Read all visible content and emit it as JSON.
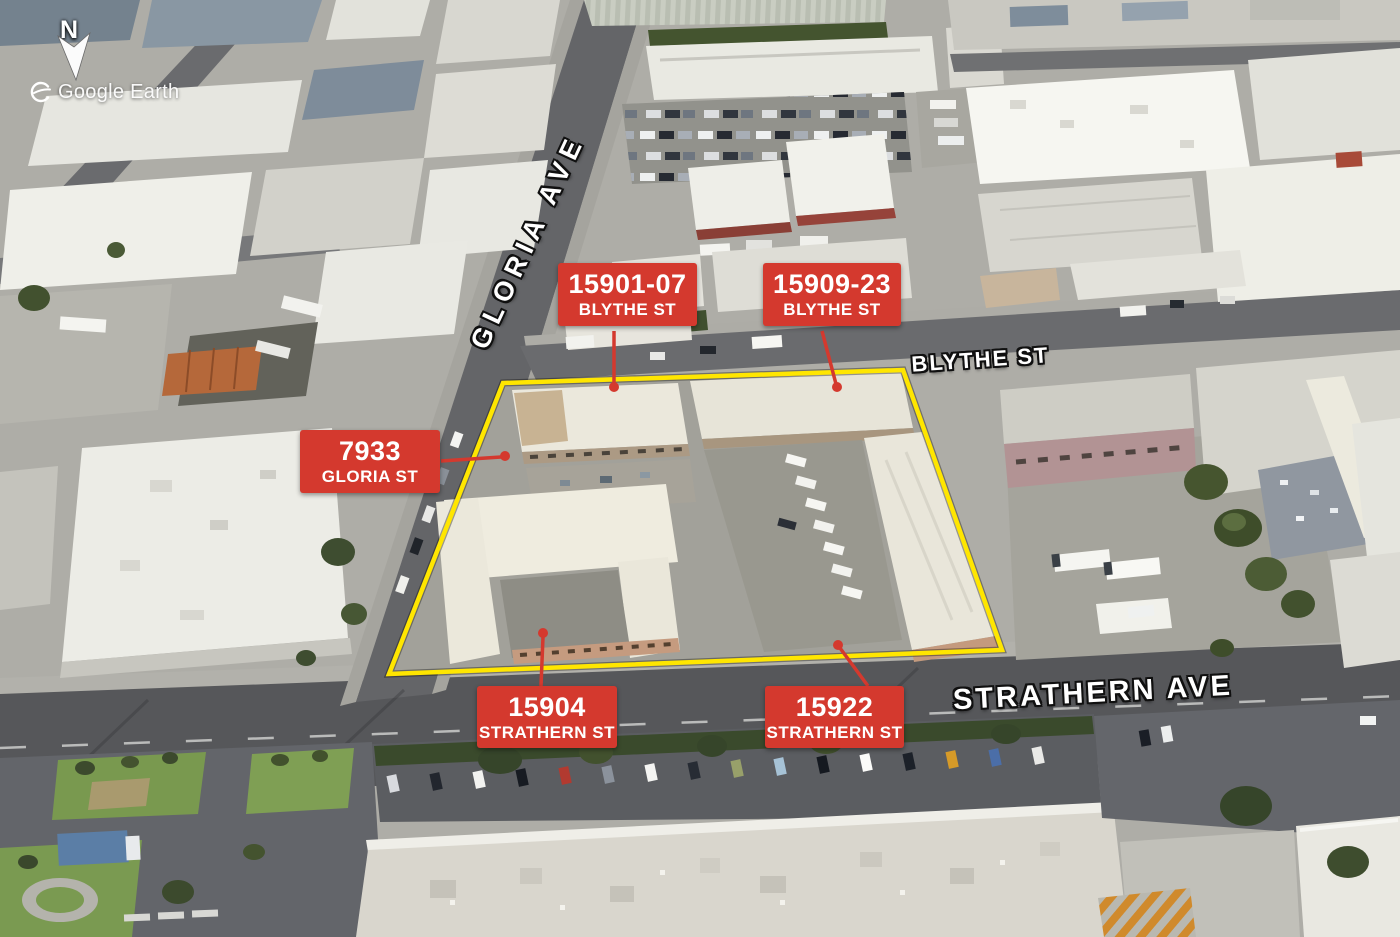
{
  "attribution": {
    "text": "Google Earth"
  },
  "compass": {
    "label": "N"
  },
  "street_labels": {
    "gloria": "GLORIA AVE",
    "blythe": "BLYTHE ST",
    "strathern": "STRATHERN AVE"
  },
  "property_labels": {
    "blythe_a": {
      "line1": "15901-07",
      "line2": "BLYTHE ST"
    },
    "blythe_b": {
      "line1": "15909-23",
      "line2": "BLYTHE ST"
    },
    "gloria": {
      "line1": "7933",
      "line2": "GLORIA ST"
    },
    "strathern_a": {
      "line1": "15904",
      "line2": "STRATHERN ST"
    },
    "strathern_b": {
      "line1": "15922",
      "line2": "STRATHERN ST"
    }
  },
  "colors": {
    "label_bg": "#d4392e",
    "label_text": "#ffffff",
    "boundary": "#ffe600",
    "leader": "#d4392e",
    "street_text": "#ffffff"
  }
}
